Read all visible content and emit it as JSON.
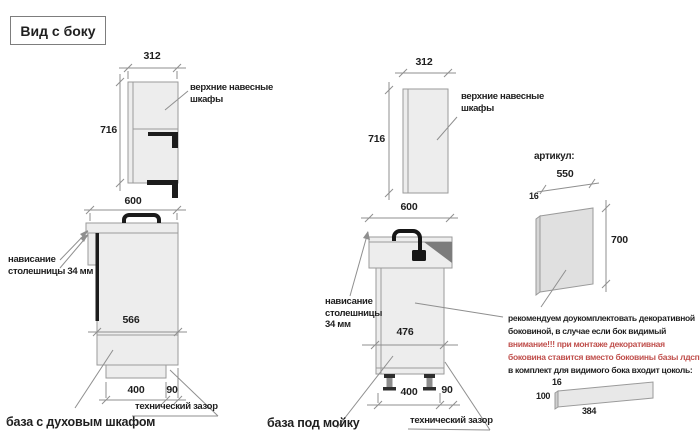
{
  "title": "Вид с боку",
  "colors": {
    "warning_red": "#c0504d",
    "drawing_line": "#8f8f8f",
    "cabinet_fill": "#ededed"
  },
  "oven_section": {
    "wall_cabinet": {
      "width_mm": "312",
      "height_mm": "716",
      "label": "верхние навесные шкафы"
    },
    "base_cabinet": {
      "width_mm": "600",
      "inner_mm": "566",
      "plinth_mm": "400",
      "gap_mm": "90",
      "overhang_label": "нависание столешницы 34 мм",
      "gap_label": "технический зазор",
      "caption": "база с духовым шкафом"
    }
  },
  "sink_section": {
    "wall_cabinet": {
      "width_mm": "312",
      "height_mm": "716",
      "label": "верхние навесные шкафы"
    },
    "base_cabinet": {
      "width_mm": "600",
      "inner_mm": "476",
      "plinth_mm": "400",
      "gap_mm": "90",
      "overhang_label": "нависание столешницы 34 мм",
      "gap_label": "технический зазор",
      "caption": "база под мойку"
    }
  },
  "panel_section": {
    "heading": "артикул:",
    "panel_width_mm": "550",
    "panel_thickness_mm": "16",
    "panel_height_mm": "700",
    "note_line1": "рекомендуем доукомплектовать декоративной",
    "note_line2": "боковиной, в случае если бок видимый",
    "warning_line1": "внимание!!! при монтаже декоративная",
    "warning_line2": "боковина ставится вместо боковины базы лдсп",
    "note_line3": "в комплект для видимого бока входит цоколь:",
    "plinth_thickness_mm": "16",
    "plinth_height_mm": "100",
    "plinth_length_mm": "384"
  }
}
